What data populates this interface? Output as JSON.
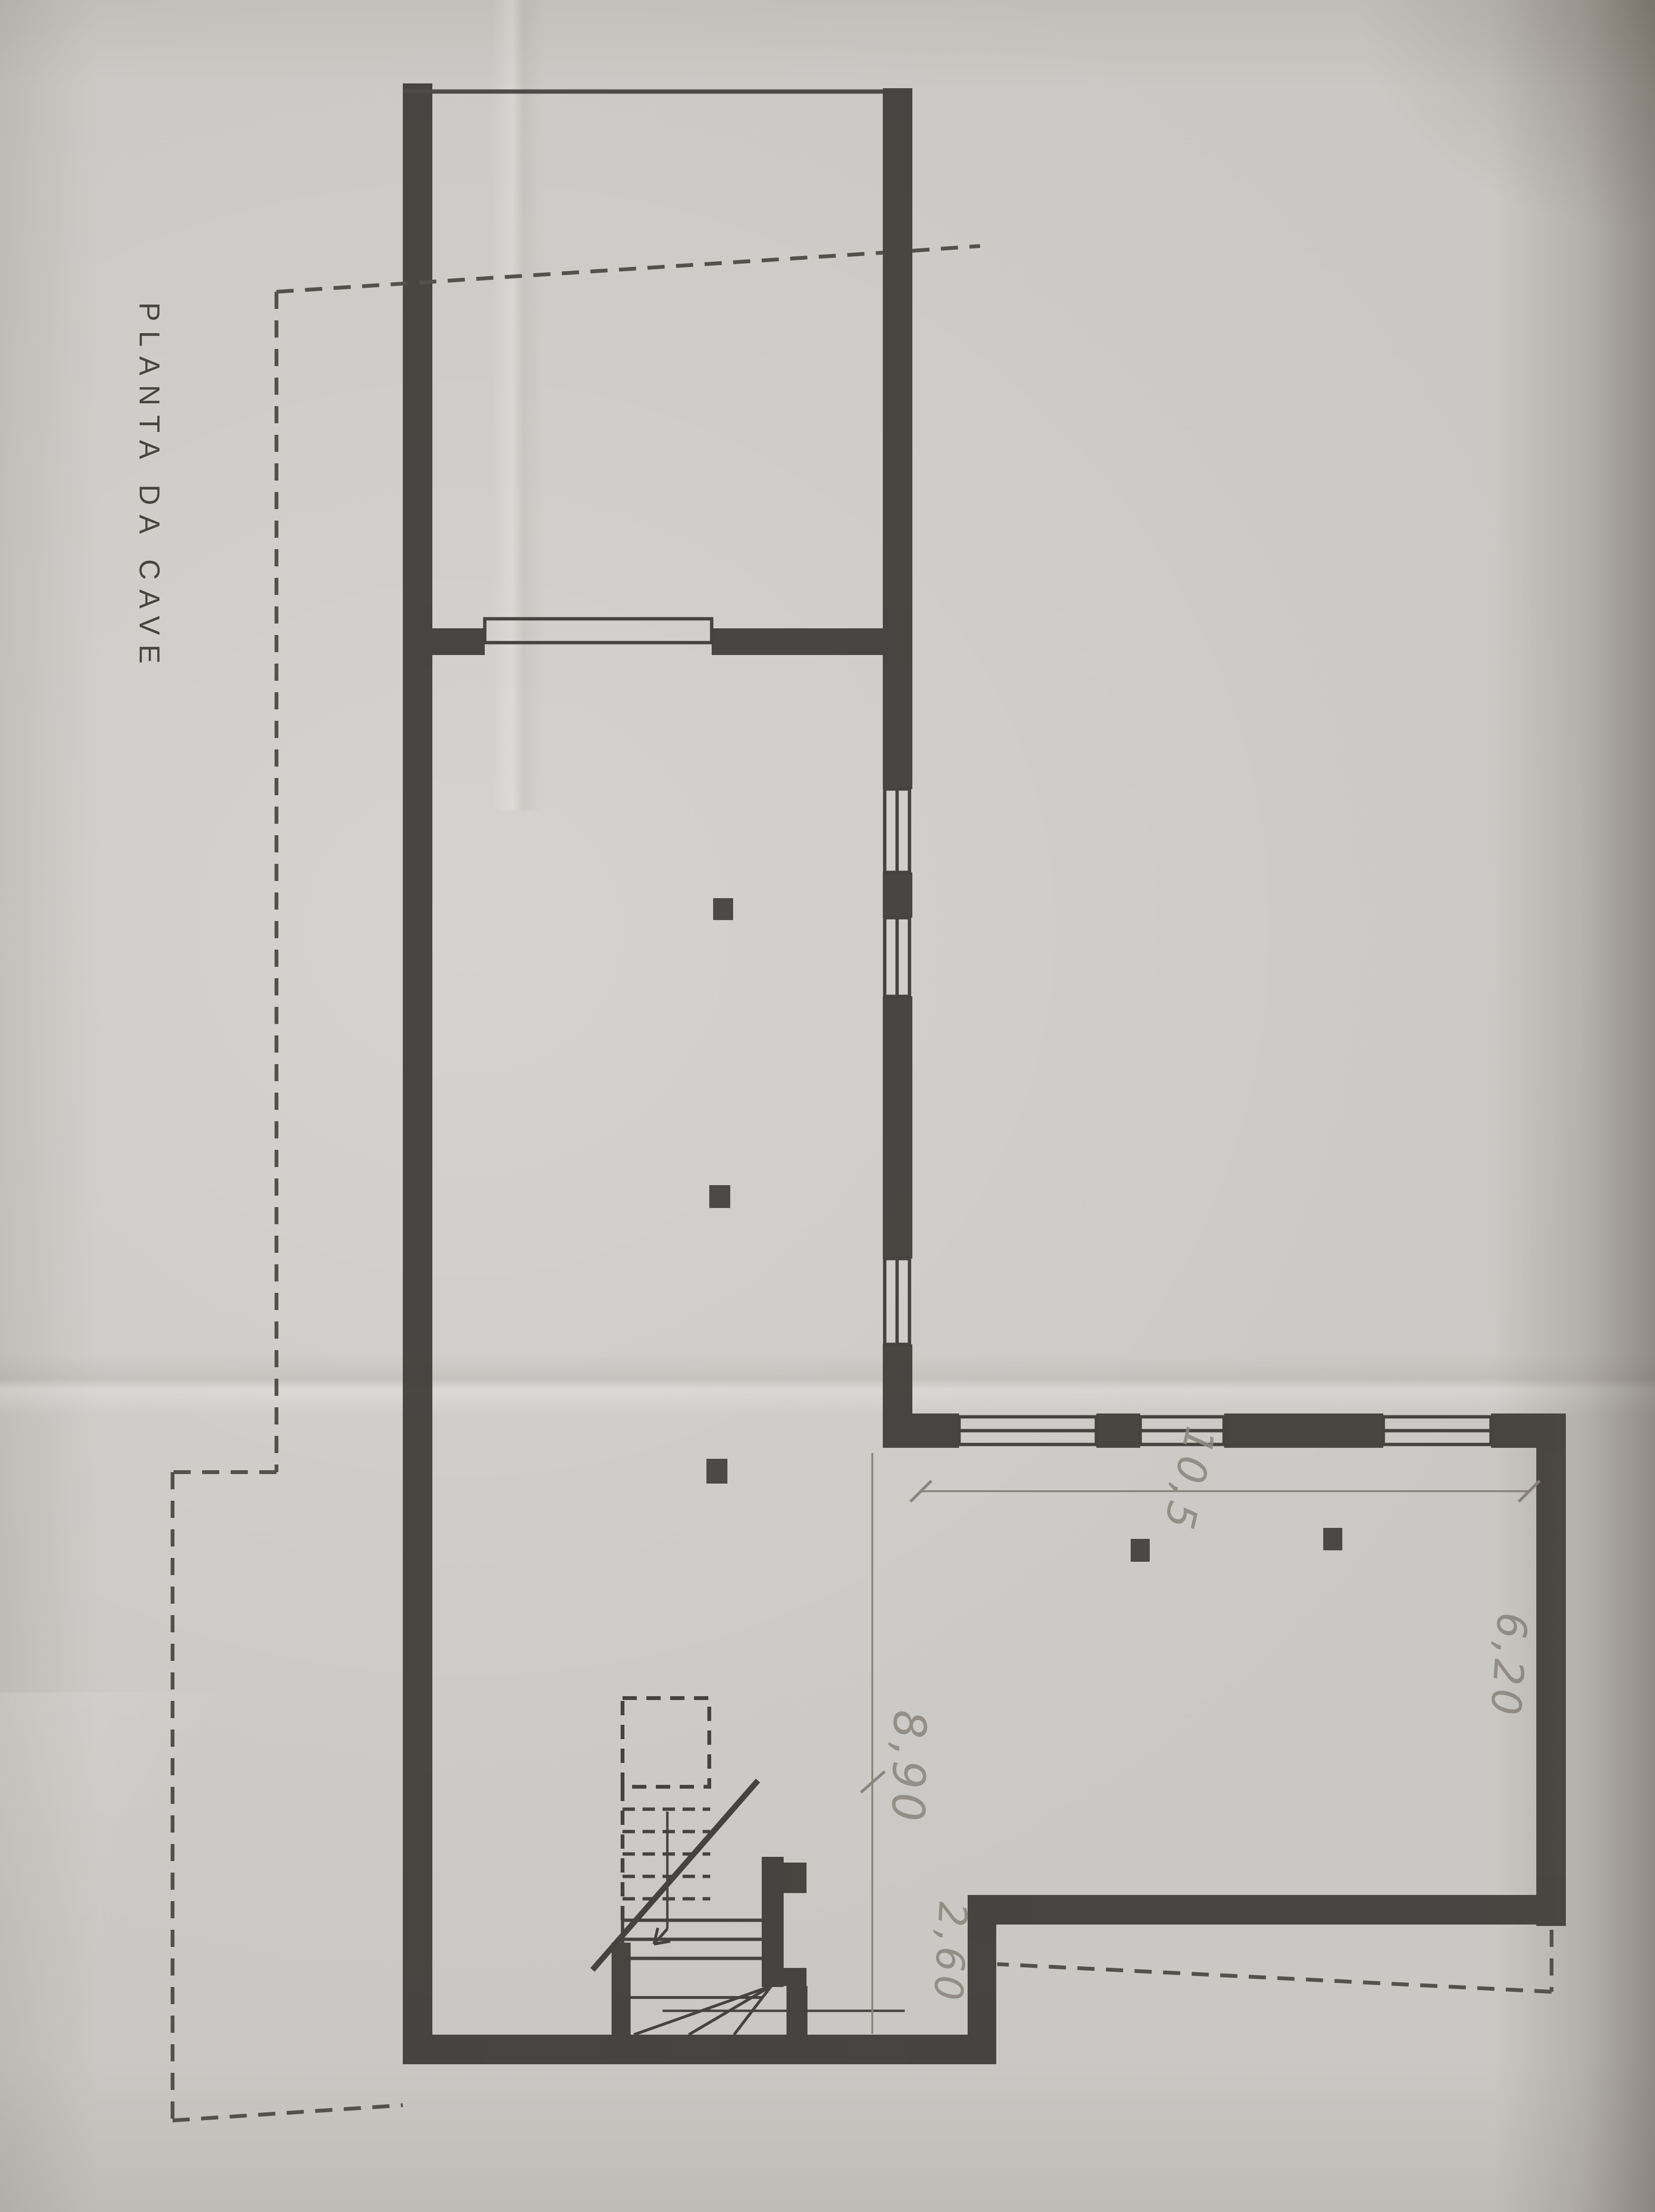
{
  "plan": {
    "title": "PLANTA DA CAVE",
    "dimension_labels": [
      {
        "id": "dim-8-90",
        "text": "8,90"
      },
      {
        "id": "dim-2-60",
        "text": "2,60"
      },
      {
        "id": "dim-6-20",
        "text": "6,20"
      },
      {
        "id": "dim-10-5",
        "text": "10,5"
      }
    ],
    "colors": {
      "ink": "#3d3b37",
      "paper": "#c8c6c2",
      "pencil": "#8d8880"
    }
  }
}
